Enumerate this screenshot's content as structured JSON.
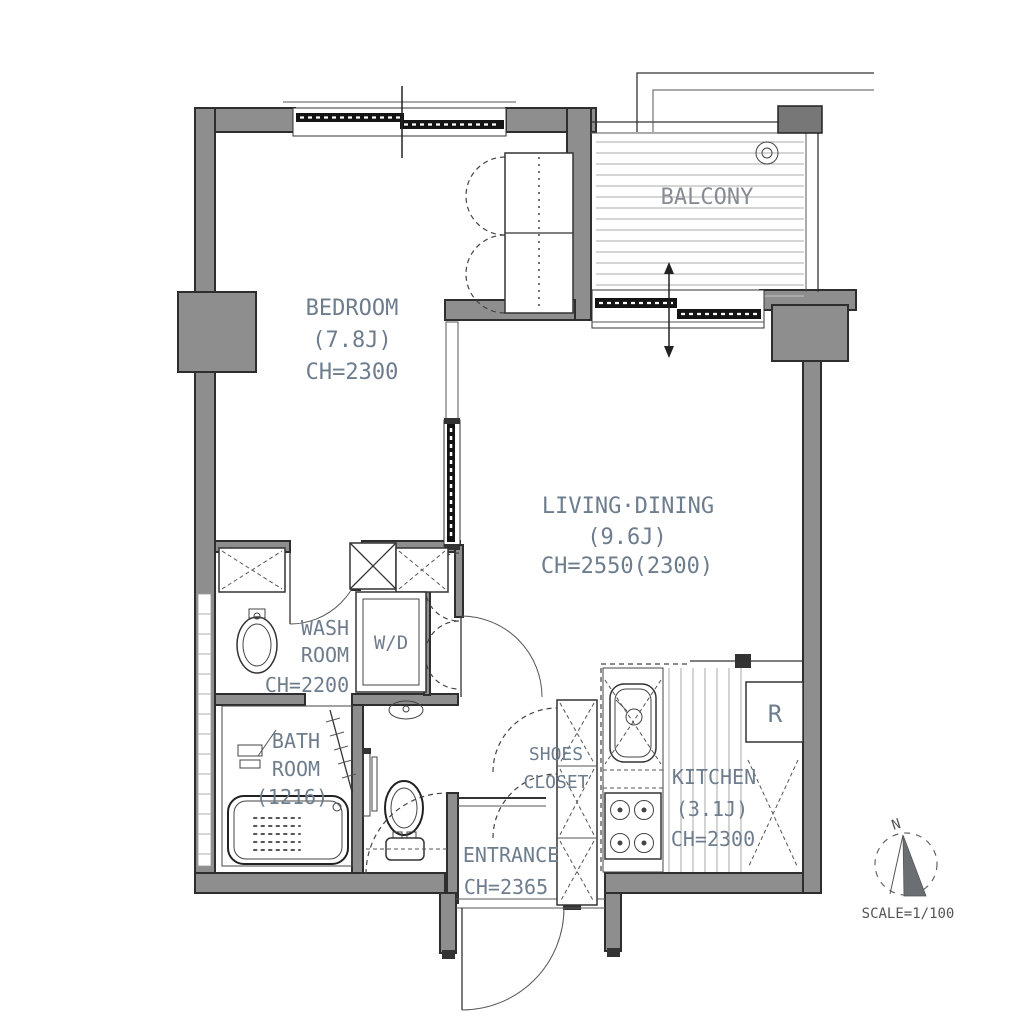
{
  "rooms": {
    "bedroom": {
      "name": "BEDROOM",
      "size": "(7.8J)",
      "ceiling": "CH=2300"
    },
    "balcony": {
      "name": "BALCONY"
    },
    "living_dining": {
      "name": "LIVING·DINING",
      "size": "(9.6J)",
      "ceiling": "CH=2550(2300)"
    },
    "wash_room": {
      "name_line1": "WASH",
      "name_line2": "ROOM",
      "ceiling": "CH=2200"
    },
    "bath_room": {
      "name_line1": "BATH",
      "name_line2": "ROOM",
      "size": "(1216)"
    },
    "shoes_closet": {
      "name_line1": "SHOES",
      "name_line2": "CLOSET"
    },
    "entrance": {
      "name": "ENTRANCE",
      "ceiling": "CH=2365"
    },
    "kitchen": {
      "name": "KITCHEN",
      "size": "(3.1J)",
      "ceiling": "CH=2300"
    }
  },
  "fixtures": {
    "washer_dryer": "W/D",
    "refrigerator": "R"
  },
  "compass": {
    "north": "N"
  },
  "scale_label": "SCALE=1/100",
  "colors": {
    "wall_fill": "#8e8e8e",
    "wall_outline": "#2e2e2e",
    "room_label": "#6e7d8d",
    "balcony_label": "#878c93",
    "floor_hatch": "#bcbcbc",
    "background": "#ffffff"
  }
}
